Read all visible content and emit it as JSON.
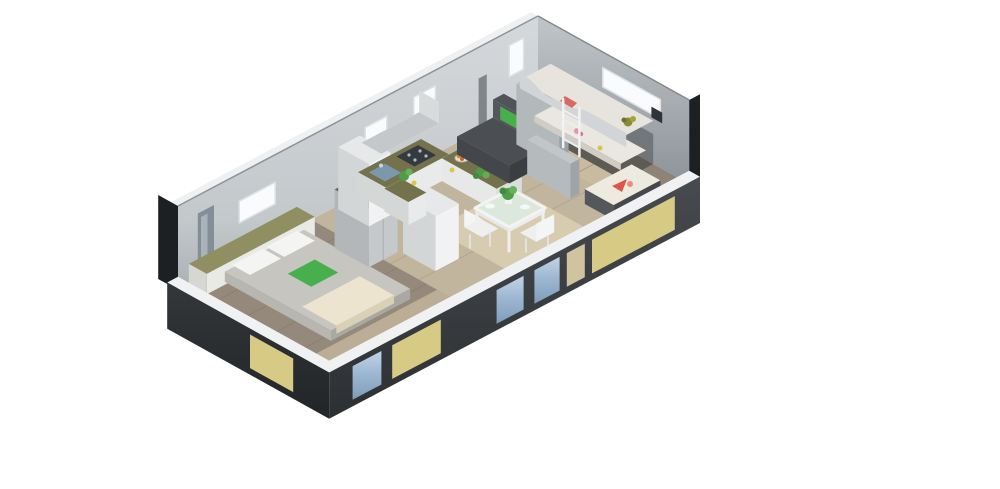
{
  "meta": {
    "title": "3D isometric cutaway floor plan render of a small home",
    "view": "isometric cutaway, white background"
  },
  "colors": {
    "background": "#ffffff",
    "wall_light": "#ccd0d3",
    "wall_shadow": "#979da2",
    "edge_dark": "#1c2023",
    "floor_wood": "#95897b",
    "floor_center": "#c2b59d",
    "floor_kids": "#8d8477",
    "rug": "#d7cbb0",
    "siding_dark": "#3b3f43",
    "panel_yellow": "#d6ca84",
    "window_blue": "#9db8d2",
    "window_white": "#fafbfc",
    "furniture_white": "#f1f2f3",
    "counter_olive": "#73724d",
    "sofa_charcoal": "#4b4f53",
    "pillow_green": "#47b04c",
    "bed_gray": "#c6c5c0",
    "blanket_beige": "#ece4cf",
    "accent_red": "#e05548",
    "glass_green": "#dce8dc",
    "sink_blue": "#7c98ad"
  },
  "scene": {
    "style": "architectural 3D dollhouse render, front walls cut low",
    "rooms": [
      {
        "name": "bedroom",
        "position": "left",
        "items": [
          "double-bed",
          "white-pillows",
          "green-pillow",
          "beige-blanket",
          "headboard-shelf",
          "mirror-panel",
          "gray-wardrobe",
          "white-wardrobe",
          "back-window"
        ]
      },
      {
        "name": "kitchen",
        "position": "center-back",
        "items": [
          "tall-cabinet",
          "overhead-cabinets",
          "sink-counter",
          "cooktop",
          "peninsula-counter",
          "fruit-bowl",
          "greens",
          "two-back-windows"
        ]
      },
      {
        "name": "living-dining",
        "position": "center-front",
        "items": [
          "charcoal-sofa",
          "two-green-cushions",
          "glass-dining-table",
          "potted-plant",
          "white-chairs",
          "beige-rug",
          "partition-wardrobes"
        ]
      },
      {
        "name": "kids-room",
        "position": "right",
        "items": [
          "bunk-bed",
          "wavy-guard-rail",
          "white-ladder",
          "lower-bunk",
          "pink-toy",
          "bench-seat",
          "watermelon-slice",
          "tall-back-window",
          "wide-end-window",
          "wall-shelf"
        ]
      }
    ],
    "exterior": {
      "cut_walls": "front long wall and left end wall cut to knee height",
      "siding": "dark gray base with pale yellow panels",
      "exterior_windows": "blue tinted glass seen from outside"
    }
  }
}
